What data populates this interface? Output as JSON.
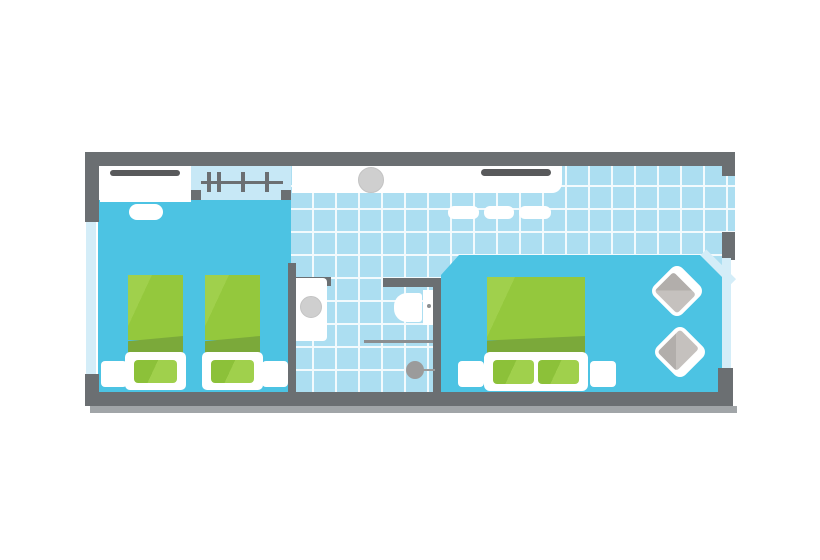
{
  "meta": {
    "description": "hotel-room-floor-plan",
    "rooms": [
      "twin-bedroom",
      "entry-corridor",
      "bathroom",
      "double-bedroom"
    ],
    "openings": [
      "left-window",
      "right-window",
      "entrance-gap",
      "bathroom-doorway"
    ],
    "furniture": [
      "closet-with-rail",
      "wardrobe-with-hangers",
      "vanity-counter",
      "sink",
      "towel-rail",
      "mat",
      "mat",
      "mat",
      "door-mat",
      "twin-bed",
      "twin-bed",
      "double-bed",
      "nightstand",
      "nightstand",
      "nightstand",
      "nightstand",
      "armchair",
      "armchair",
      "washbasin",
      "toilet",
      "shower-screen",
      "shower-drain"
    ],
    "hanger_count": 4
  },
  "colors": {
    "wall": "#6B6F72",
    "wall-shadow": "#A1A5A8",
    "floor": "#4CC3E3",
    "tile": "#ACDEF1",
    "tile-line": "#F2FAFD",
    "window": "#D4EDF8",
    "recess": "#C7E8F6",
    "white": "#FFFFFF",
    "green": "#94C83D",
    "green-light": "#A0D04C",
    "green-mid": "#8CC139",
    "green-dark": "#7BA93A",
    "rail": "#58595B",
    "fixture": "#CFCFCF",
    "metal": "#8B8E90",
    "drain": "#9B9B9B",
    "chair": "#C5C1BE",
    "chair-dark": "#B2AEAB"
  }
}
